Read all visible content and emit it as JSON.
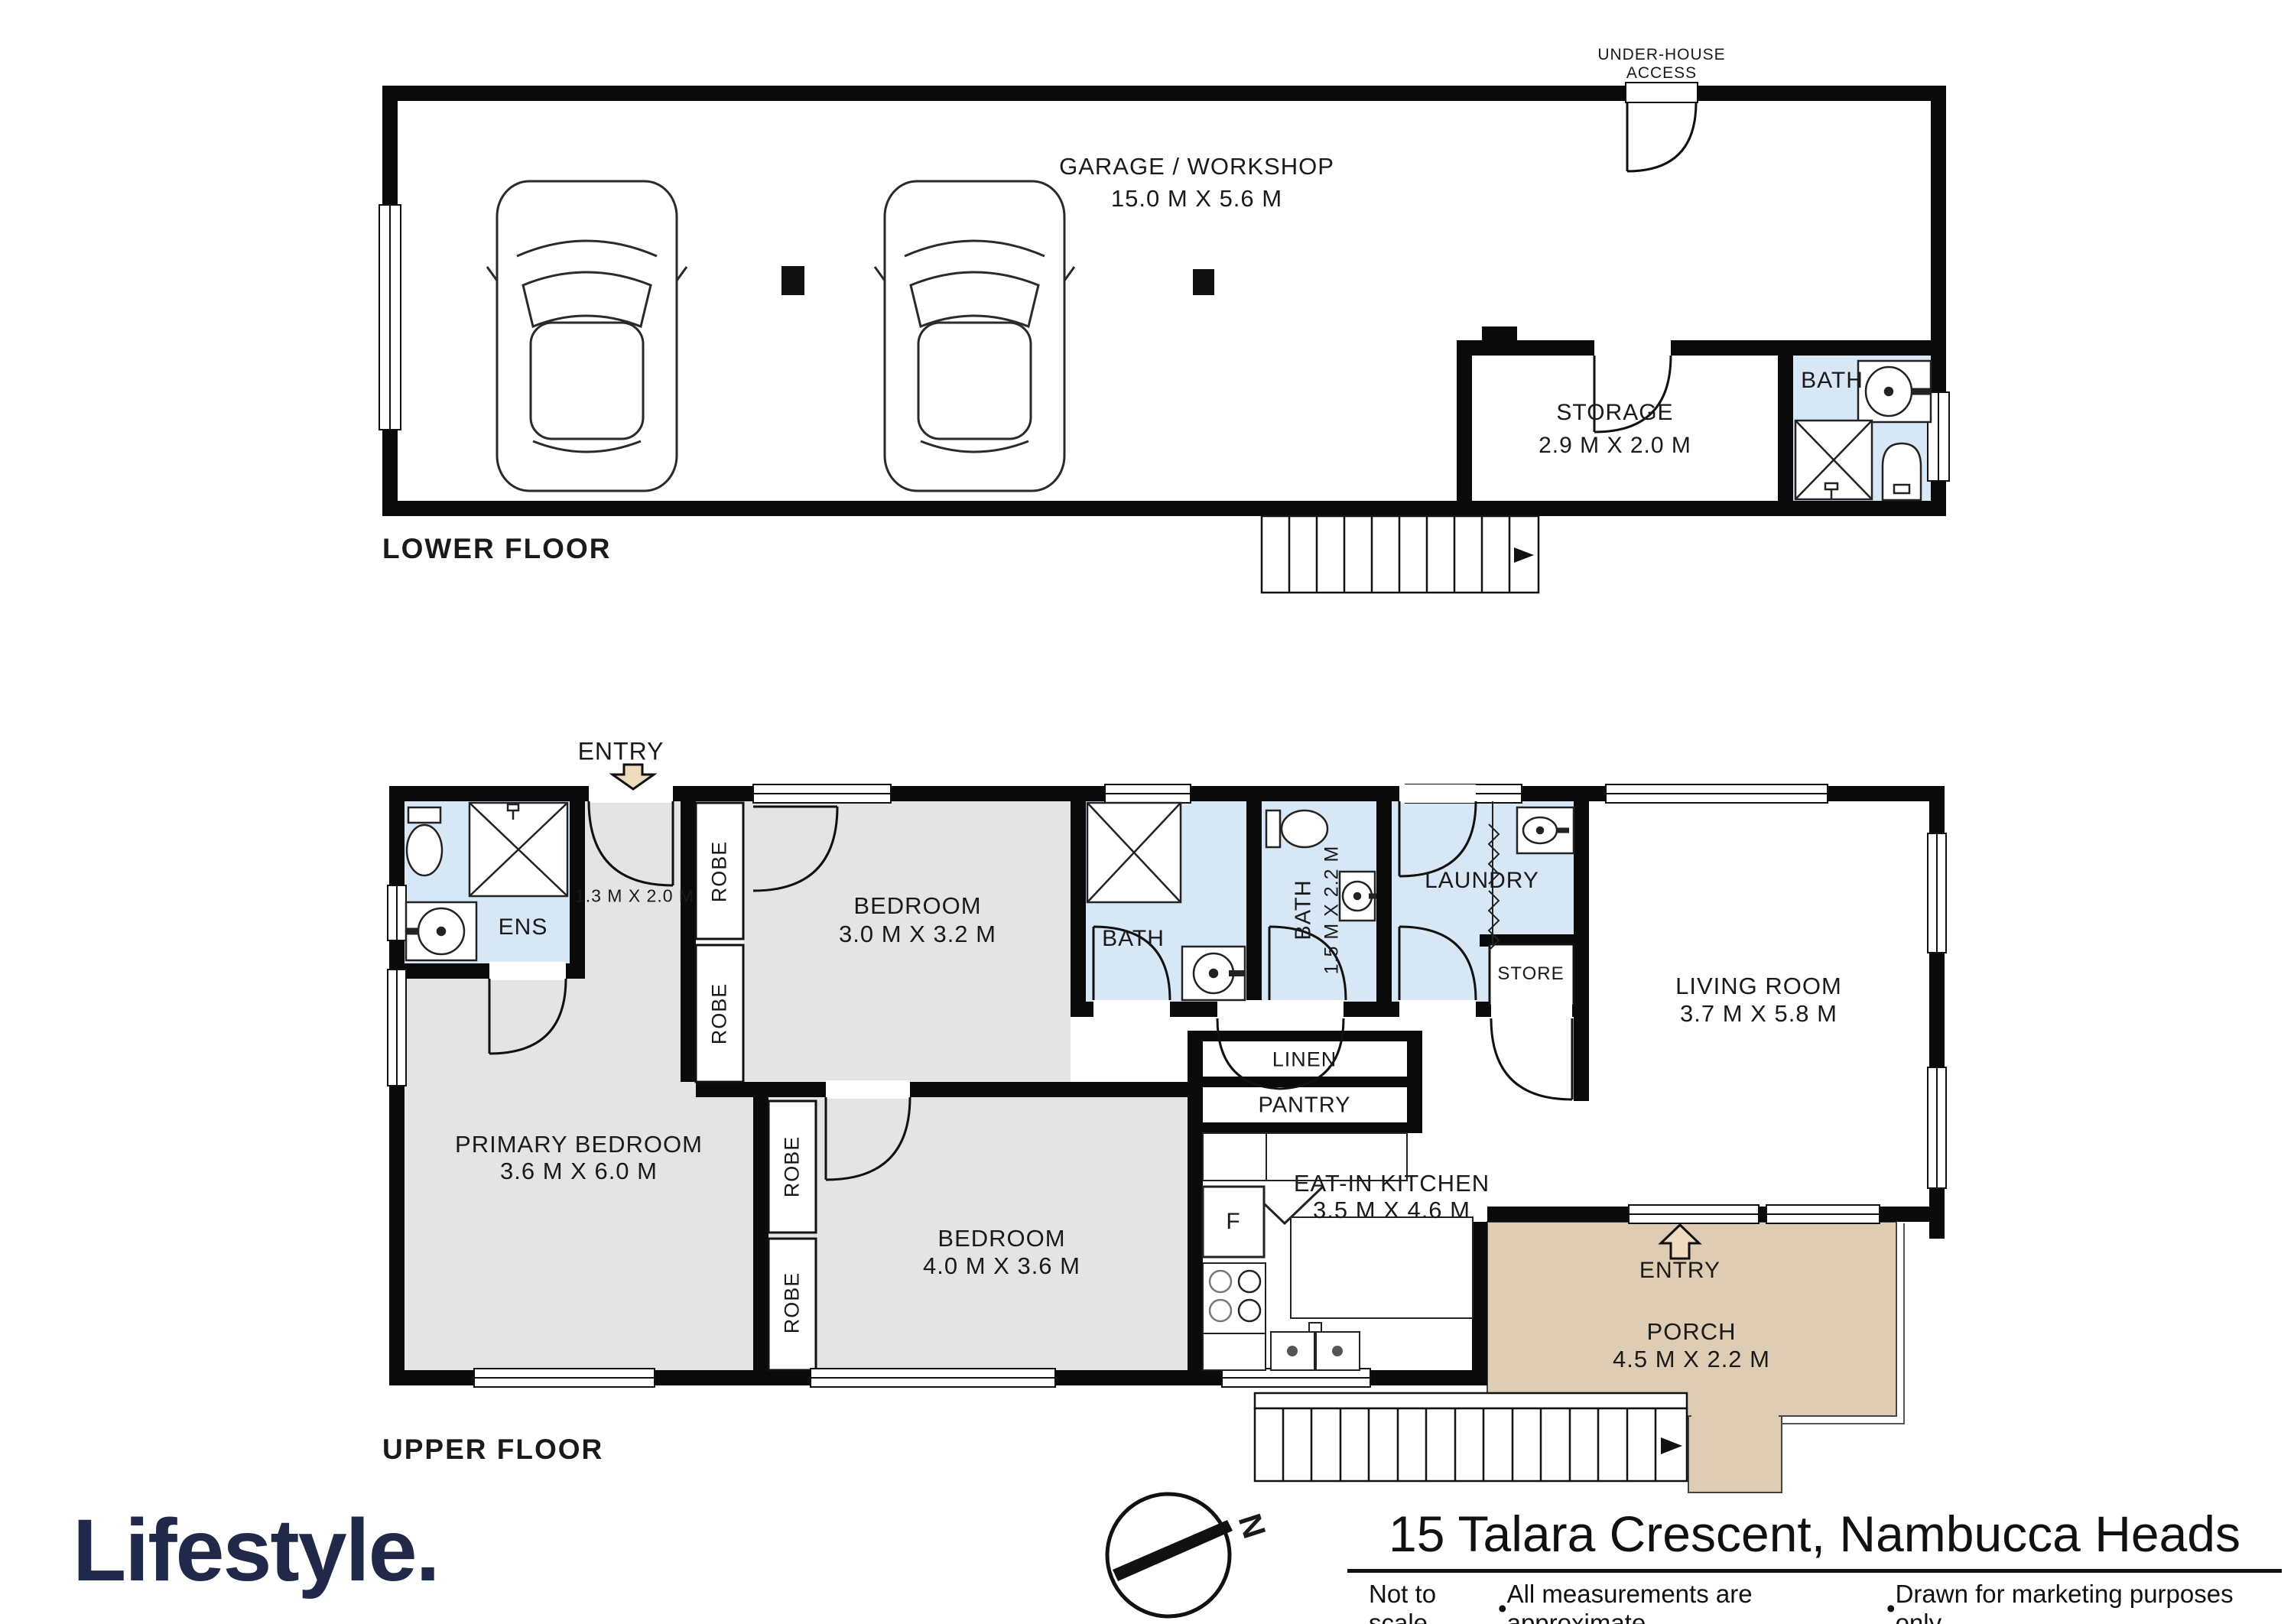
{
  "colors": {
    "wall": "#0a0a0a",
    "bedroom_grey": "#e4e4e4",
    "bath_blue": "#d7e7f6",
    "porch_tan": "#decdb4",
    "brand_navy": "#20294a"
  },
  "lower_floor": {
    "label": "LOWER FLOOR",
    "garage_name": "GARAGE / WORKSHOP",
    "garage_dims": "15.0 M X 5.6 M",
    "under_house_line1": "UNDER-HOUSE",
    "under_house_line2": "ACCESS",
    "storage_name": "STORAGE",
    "storage_dims": "2.9 M X 2.0 M",
    "bath_label": "BATH"
  },
  "upper_floor": {
    "label": "UPPER FLOOR",
    "entry_label": "ENTRY",
    "ens_label": "ENS",
    "entry_hall_dims": "1.3 M X 2.0 M",
    "robe_label": "ROBE",
    "bedroom1_name": "BEDROOM",
    "bedroom1_dims": "3.0 M X 3.2 M",
    "bath1_label": "BATH",
    "bath2_label": "BATH",
    "bath2_dims": "1.5 M X 2.2 M",
    "laundry_label": "LAUNDRY",
    "store_label": "STORE",
    "living_name": "LIVING ROOM",
    "living_dims": "3.7 M X 5.8 M",
    "linen_label": "LINEN",
    "pantry_label": "PANTRY",
    "fridge_label": "F",
    "kitchen_name": "EAT-IN KITCHEN",
    "kitchen_dims": "3.5 M X 4.6 M",
    "primary_name": "PRIMARY BEDROOM",
    "primary_dims": "3.6 M X 6.0 M",
    "bedroom2_name": "BEDROOM",
    "bedroom2_dims": "4.0 M X 3.6 M",
    "porch_entry_label": "ENTRY",
    "porch_name": "PORCH",
    "porch_dims": "4.5 M X 2.2 M"
  },
  "footer": {
    "brand": "Lifestyle.",
    "compass_north": "N",
    "address": "15 Talara Crescent, Nambucca Heads",
    "bullet": "•",
    "disclaimer": [
      "Not to scale",
      "All measurements are approximate",
      "Drawn for marketing purposes only"
    ]
  }
}
